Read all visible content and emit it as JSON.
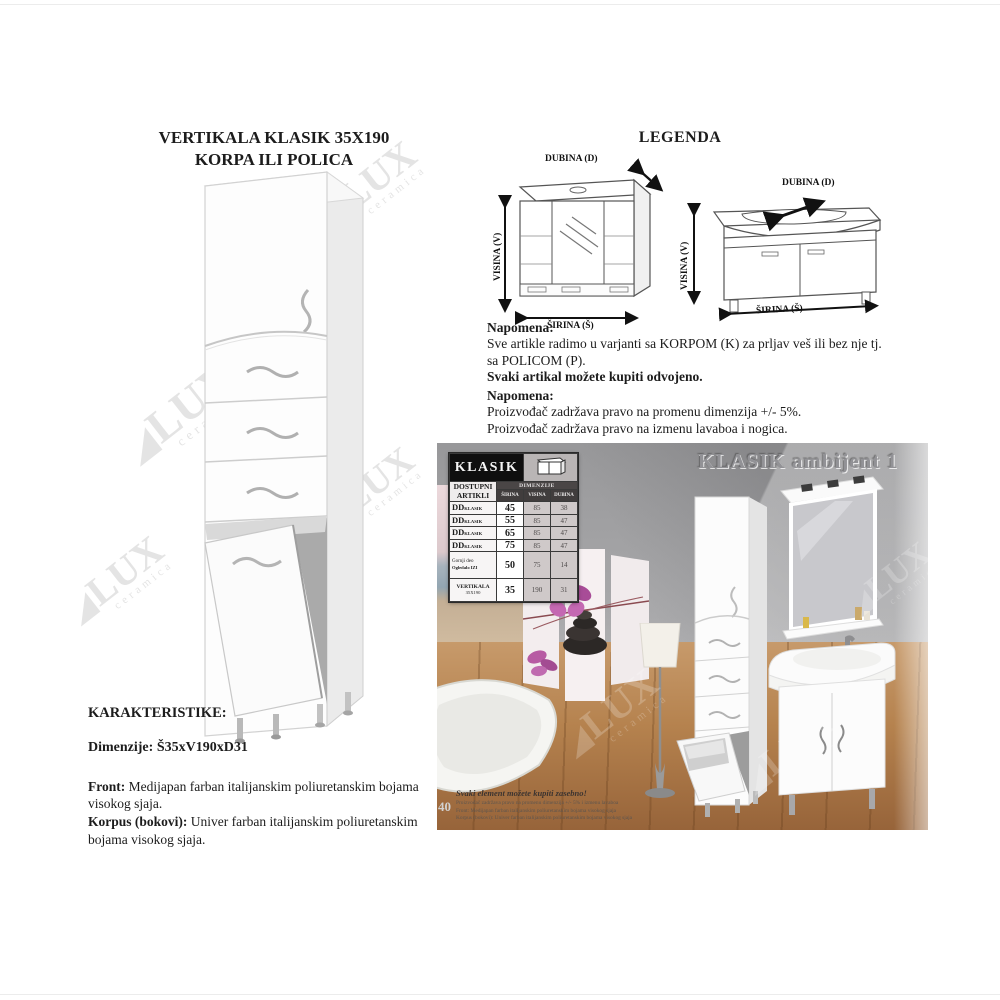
{
  "watermark": {
    "glyph": "◢",
    "text": "LUX",
    "sub": "ceramica"
  },
  "product": {
    "title_line1": "VERTIKALA KLASIK 35X190",
    "title_line2": "KORPA ILI POLICA"
  },
  "legend": {
    "heading": "LEGENDA",
    "labels": {
      "depth": "DUBINA (D)",
      "height": "VISINA (V)",
      "width": "ŠIRINA (Š)"
    }
  },
  "note1": {
    "heading": "Napomena:",
    "line1": "Sve artikle radimo u varjanti sa KORPOM (K) za prljav veš ili bez nje tj.",
    "line2": "sa POLICOM (P).",
    "line3": "Svaki artikal možete kupiti odvojeno."
  },
  "note2": {
    "heading": "Napomena:",
    "line1": "Proizvođač zadržava pravo na promenu dimenzija +/- 5%.",
    "line2": "Proizvođač zadržava pravo na izmenu lavaboa i nogica."
  },
  "characteristics": {
    "heading": "KARAKTERISTIKE:",
    "dim_label": "Dimenzije:",
    "dim_value": "Š35xV190xD31",
    "front_label": "Front:",
    "front_text": "Medijapan farban italijanskim poliuretanskim bojama visokog sjaja.",
    "korpus_label": "Korpus (bokovi):",
    "korpus_text": "Univer farban italijanskim poliuretanskim bojama visokog sjaja."
  },
  "ambient": {
    "title": "KLASIK ambijent 1",
    "caption_bold": "Svaki element možete kupiti zasebno!",
    "caption_line1": "Proizvođač zadržava pravo na promenu dimenzija +/- 5% i izmenu lavaboa",
    "caption_line2": "Front: Medijapan farban italijanskim poliuretanskim bojama visokog sjaja",
    "caption_line3": "Korpus (bokovi): Univer farban italijanskim poliuretanskim bojama visokog sjaja",
    "page_number": "40"
  },
  "table": {
    "title": "KLASIK",
    "artikli_line1": "DOSTUPNI",
    "artikli_line2": "ARTIKLI",
    "col_group": "DIMENZIJE",
    "cols": [
      "ŠIRINA",
      "VISINA",
      "DUBINA"
    ],
    "rows": [
      {
        "name": "DD",
        "sub": "KLASIK",
        "sirina": "45",
        "visina": "85",
        "dubina": "38"
      },
      {
        "name": "DD",
        "sub": "KLASIK",
        "sirina": "55",
        "visina": "85",
        "dubina": "47"
      },
      {
        "name": "DD",
        "sub": "KLASIK",
        "sirina": "65",
        "visina": "85",
        "dubina": "47"
      },
      {
        "name": "DD",
        "sub": "KLASIK",
        "sirina": "75",
        "visina": "85",
        "dubina": "47"
      },
      {
        "name": "Gornji deo",
        "sub": "Ogledalo IZI",
        "sirina": "50",
        "visina": "75",
        "dubina": "14"
      },
      {
        "name": "VERTIKALA",
        "sub": "35X190",
        "sirina": "35",
        "visina": "190",
        "dubina": "31"
      }
    ]
  },
  "colors": {
    "table_header_bg": "#0f0f0f",
    "wall_gray": "#a6a6a8",
    "wood": "#b5804f",
    "orchid_pink": "#b75ba3",
    "text": "#1c1c1c"
  }
}
